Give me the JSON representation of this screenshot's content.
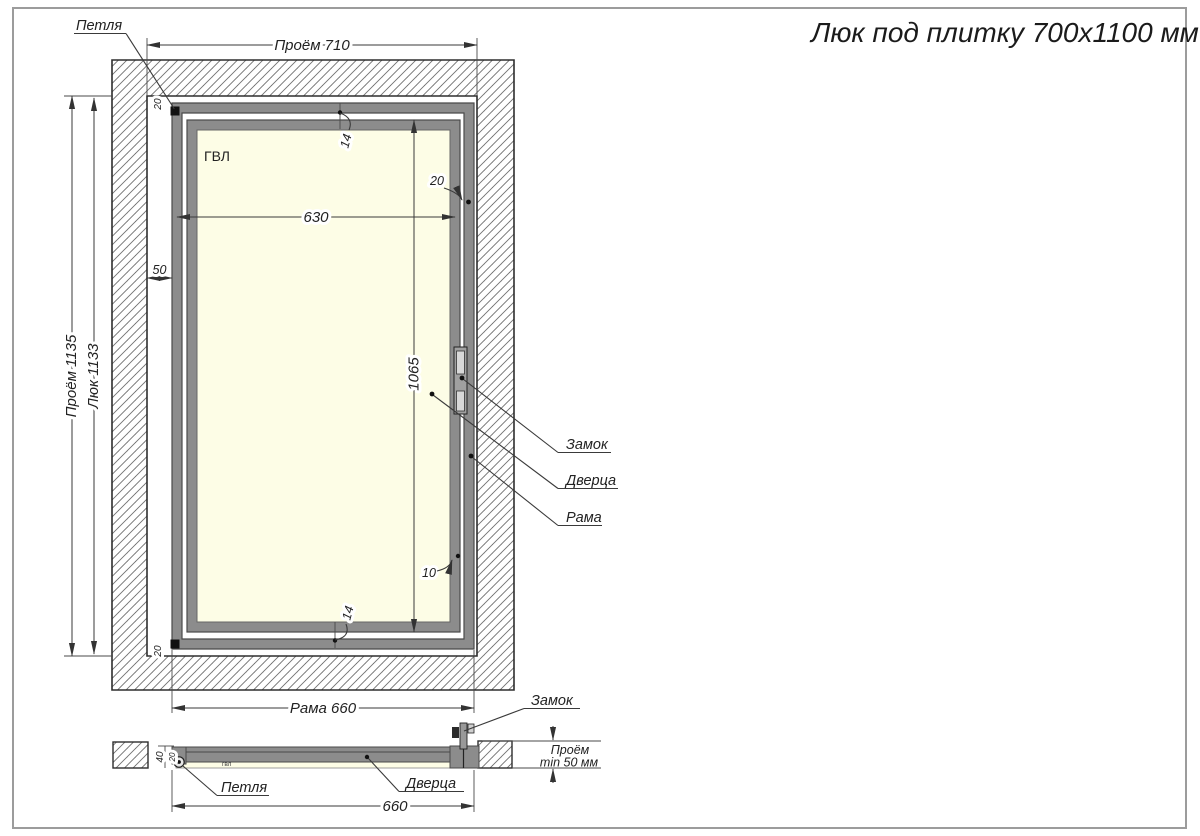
{
  "title": "Люк под плитку 700х1100 мм",
  "front": {
    "material": "ГВЛ",
    "callouts": {
      "hinge": "Петля",
      "lock": "Замок",
      "door": "Дверца",
      "frame": "Рама"
    },
    "dims": {
      "opening_width": "Проём 710",
      "opening_height": "Проём 1135",
      "hatch_height": "Люк 1133",
      "panel_width": "630",
      "door_height": "1065",
      "side_gap": "50",
      "frame_offset": "20",
      "top_gap": "14",
      "bottom_gap": "14",
      "right_gap": "10",
      "hinge_top": "20",
      "hinge_bottom": "20",
      "frame_width": "Рама 660"
    }
  },
  "section": {
    "material": "гвл",
    "callouts": {
      "lock": "Замок",
      "hinge": "Петля",
      "door": "Дверца"
    },
    "dims": {
      "width": "660",
      "depth": "40",
      "hinge_inset": "20"
    },
    "note": {
      "line1": "Проём",
      "line2": "min 50 мм"
    }
  },
  "colors": {
    "frame_gray": "#8c8c8c",
    "panel_cream": "#fdfde6",
    "line": "#333333"
  }
}
